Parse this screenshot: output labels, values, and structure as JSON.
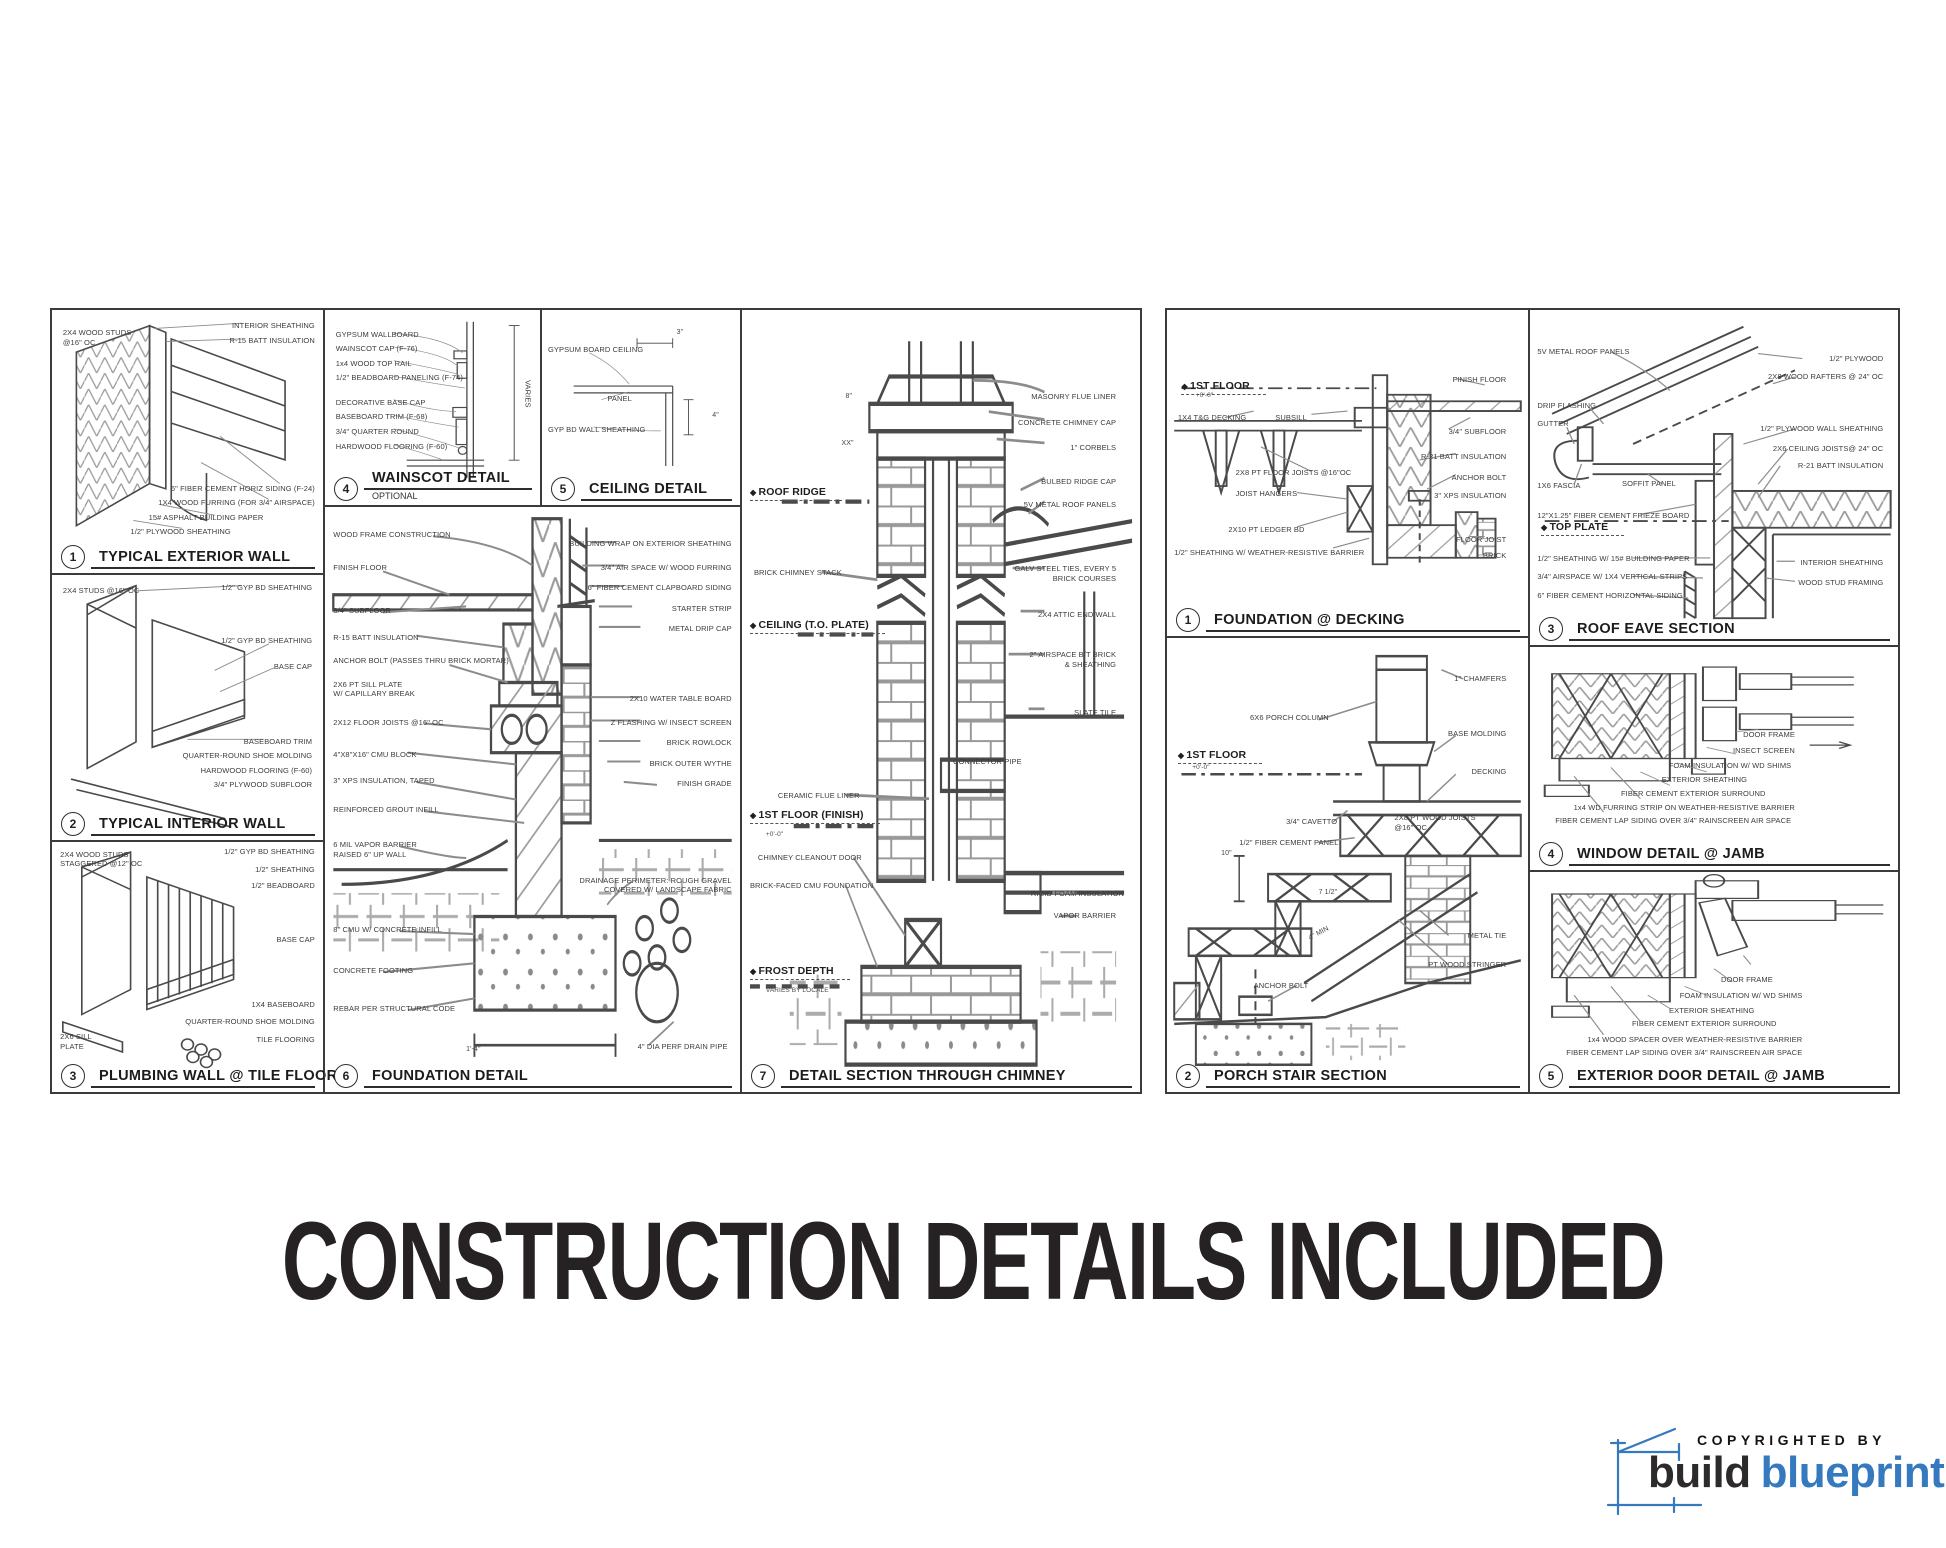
{
  "page": {
    "title": "CONSTRUCTION DETAILS INCLUDED"
  },
  "logo": {
    "copyright": "COPYRIGHTED BY",
    "brand_dark": "build",
    "brand_accent": "blueprint",
    "accent_color": "#3579be",
    "dark_color": "#2d2a2b"
  },
  "left_sheet": {
    "panels": [
      {
        "num": "1",
        "title": "TYPICAL EXTERIOR WALL",
        "labels": [
          {
            "t": "2X4 WOOD STUDS\n@16\" OC",
            "x": 4,
            "y": 7
          },
          {
            "t": "INTERIOR SHEATHING",
            "x": 97,
            "y": 4,
            "a": "r"
          },
          {
            "t": "R-15 BATT INSULATION",
            "x": 97,
            "y": 10,
            "a": "r"
          },
          {
            "t": "6\" FIBER CEMENT HORIZ SIDING (F-24)",
            "x": 97,
            "y": 66,
            "a": "r"
          },
          {
            "t": "1X4 WOOD FURRING (FOR 3/4\" AIRSPACE)",
            "x": 97,
            "y": 71.5,
            "a": "r"
          },
          {
            "t": "15# ASPHALT BUILDING PAPER",
            "x": 78,
            "y": 77,
            "a": "r"
          },
          {
            "t": "1/2\" PLYWOOD SHEATHING",
            "x": 66,
            "y": 82.5,
            "a": "r"
          }
        ]
      },
      {
        "num": "2",
        "title": "TYPICAL INTERIOR WALL",
        "labels": [
          {
            "t": "2X4 STUDS @16\" OC",
            "x": 4,
            "y": 4
          },
          {
            "t": "1/2\" GYP BD SHEATHING",
            "x": 96,
            "y": 3,
            "a": "r"
          },
          {
            "t": "1/2\" GYP BD SHEATHING",
            "x": 96,
            "y": 23,
            "a": "r"
          },
          {
            "t": "BASE CAP",
            "x": 96,
            "y": 33,
            "a": "r"
          },
          {
            "t": "BASEBOARD TRIM",
            "x": 96,
            "y": 61,
            "a": "r"
          },
          {
            "t": "QUARTER-ROUND SHOE MOLDING",
            "x": 96,
            "y": 66.5,
            "a": "r"
          },
          {
            "t": "HARDWOOD FLOORING (F-60)",
            "x": 96,
            "y": 72,
            "a": "r"
          },
          {
            "t": "3/4\" PLYWOOD SUBFLOOR",
            "x": 96,
            "y": 77.5,
            "a": "r"
          }
        ]
      },
      {
        "num": "3",
        "title": "PLUMBING WALL @ TILE FLOOR",
        "labels": [
          {
            "t": "2X4 WOOD STUDS\nSTAGGERED @12\" OC",
            "x": 3,
            "y": 3
          },
          {
            "t": "1/2\" GYP BD SHEATHING",
            "x": 97,
            "y": 2,
            "a": "r"
          },
          {
            "t": "1/2\" SHEATHING",
            "x": 97,
            "y": 9,
            "a": "r"
          },
          {
            "t": "1/2\" BEADBOARD",
            "x": 97,
            "y": 15.5,
            "a": "r"
          },
          {
            "t": "BASE CAP",
            "x": 97,
            "y": 37,
            "a": "r"
          },
          {
            "t": "1X4 BASEBOARD",
            "x": 97,
            "y": 63,
            "a": "r"
          },
          {
            "t": "QUARTER-ROUND SHOE MOLDING",
            "x": 97,
            "y": 70,
            "a": "r"
          },
          {
            "t": "TILE FLOORING",
            "x": 97,
            "y": 77,
            "a": "r"
          },
          {
            "t": "2X6 SILL\nPLATE",
            "x": 3,
            "y": 76
          }
        ]
      },
      {
        "num": "4",
        "title": "WAINSCOT DETAIL",
        "subtitle": "OPTIONAL",
        "labels": [
          {
            "t": "GYPSUM WALLBOARD",
            "x": 5,
            "y": 10
          },
          {
            "t": "WAINSCOT CAP (F-76)",
            "x": 5,
            "y": 17.5
          },
          {
            "t": "1x4 WOOD TOP RAIL",
            "x": 5,
            "y": 25
          },
          {
            "t": "1/2\" BEADBOARD PANELING (F-74)",
            "x": 5,
            "y": 32.5
          },
          {
            "t": "DECORATIVE BASE CAP",
            "x": 5,
            "y": 45
          },
          {
            "t": "BASEBOARD TRIM (F-68)",
            "x": 5,
            "y": 52.5
          },
          {
            "t": "3/4\" QUARTER ROUND",
            "x": 5,
            "y": 60
          },
          {
            "t": "HARDWOOD FLOORING (F-60)",
            "x": 5,
            "y": 67.5
          },
          {
            "t": "VARIES",
            "x": 92,
            "y": 36,
            "cls": "vert"
          }
        ]
      },
      {
        "num": "5",
        "title": "CEILING DETAIL",
        "labels": [
          {
            "t": "GYPSUM BOARD CEILING",
            "x": 3,
            "y": 18
          },
          {
            "t": "PANEL",
            "x": 33,
            "y": 43
          },
          {
            "t": "GYP BD WALL SHEATHING",
            "x": 3,
            "y": 59
          },
          {
            "t": "3\"",
            "x": 68,
            "y": 9,
            "cls": "dim"
          },
          {
            "t": "4\"",
            "x": 86,
            "y": 52,
            "cls": "dim"
          }
        ]
      },
      {
        "num": "6",
        "title": "FOUNDATION DETAIL",
        "labels": [
          {
            "t": "WOOD FRAME CONSTRUCTION",
            "x": 2,
            "y": 4
          },
          {
            "t": "FINISH FLOOR",
            "x": 2,
            "y": 9.5
          },
          {
            "t": "3/4\" SUBFLOOR",
            "x": 2,
            "y": 17
          },
          {
            "t": "R-15 BATT INSULATION",
            "x": 2,
            "y": 21.5
          },
          {
            "t": "ANCHOR BOLT (PASSES THRU BRICK MORTAR)",
            "x": 2,
            "y": 25.5
          },
          {
            "t": "2X6 PT SILL PLATE\nW/ CAPILLARY BREAK",
            "x": 2,
            "y": 29.5
          },
          {
            "t": "2X12 FLOOR JOISTS @16\" OC",
            "x": 2,
            "y": 36
          },
          {
            "t": "4\"X8\"X16\" CMU BLOCK",
            "x": 2,
            "y": 41.5
          },
          {
            "t": "3\" XPS INSULATION, TAPED",
            "x": 2,
            "y": 46
          },
          {
            "t": "REINFORCED GROUT INFILL",
            "x": 2,
            "y": 51
          },
          {
            "t": "6 MIL VAPOR BARRIER\nRAISED 6\" UP WALL",
            "x": 2,
            "y": 57
          },
          {
            "t": "8\" CMU W/ CONCRETE INFILL",
            "x": 2,
            "y": 71.5
          },
          {
            "t": "CONCRETE FOOTING",
            "x": 2,
            "y": 78.5
          },
          {
            "t": "REBAR PER STRUCTURAL CODE",
            "x": 2,
            "y": 85
          },
          {
            "t": "BUILDING WRAP ON EXTERIOR SHEATHING",
            "x": 98,
            "y": 5.5,
            "a": "r"
          },
          {
            "t": "3/4\" AIR SPACE W/ WOOD FURRING",
            "x": 98,
            "y": 9.5,
            "a": "r"
          },
          {
            "t": "6\" FIBER CEMENT CLAPBOARD SIDING",
            "x": 98,
            "y": 13,
            "a": "r"
          },
          {
            "t": "STARTER STRIP",
            "x": 98,
            "y": 16.5,
            "a": "r"
          },
          {
            "t": "METAL DRIP CAP",
            "x": 98,
            "y": 20,
            "a": "r"
          },
          {
            "t": "2X10 WATER TABLE BOARD",
            "x": 98,
            "y": 32,
            "a": "r"
          },
          {
            "t": "Z FLASHING W/ INSECT SCREEN",
            "x": 98,
            "y": 36,
            "a": "r"
          },
          {
            "t": "BRICK ROWLOCK",
            "x": 98,
            "y": 39.5,
            "a": "r"
          },
          {
            "t": "BRICK OUTER WYTHE",
            "x": 98,
            "y": 43,
            "a": "r"
          },
          {
            "t": "FINISH GRADE",
            "x": 98,
            "y": 46.5,
            "a": "r"
          },
          {
            "t": "DRAINAGE PERIMETER: ROUGH GRAVEL\nCOVERED W/ LANDSCAPE FABRIC",
            "x": 98,
            "y": 63,
            "a": "r"
          },
          {
            "t": "4\" DIA PERF DRAIN PIPE",
            "x": 97,
            "y": 91.5,
            "a": "r"
          },
          {
            "t": "1'-4\"",
            "x": 34,
            "y": 92,
            "cls": "dim"
          }
        ]
      },
      {
        "num": "7",
        "title": "DETAIL SECTION THROUGH CHIMNEY",
        "labels": [
          {
            "t": "ROOF RIDGE",
            "x": 2,
            "y": 22.5,
            "cls": "marker"
          },
          {
            "t": "CEILING (T.O. PLATE)",
            "x": 2,
            "y": 39.5,
            "cls": "marker"
          },
          {
            "t": "1ST FLOOR (FINISH)",
            "x": 2,
            "y": 63.8,
            "cls": "marker"
          },
          {
            "t": "+0'-0\"",
            "x": 6,
            "y": 66.6,
            "cls": "sub"
          },
          {
            "t": "FROST DEPTH",
            "x": 2,
            "y": 83.8,
            "cls": "marker"
          },
          {
            "t": "VARIES BY LOCALE",
            "x": 6,
            "y": 86.6,
            "cls": "sub"
          },
          {
            "t": "BRICK CHIMNEY STACK",
            "x": 3,
            "y": 33
          },
          {
            "t": "CERAMIC FLUE LINER",
            "x": 9,
            "y": 61.5
          },
          {
            "t": "CHIMNEY CLEANOUT DOOR",
            "x": 4,
            "y": 69.5
          },
          {
            "t": "BRICK-FACED CMU FOUNDATION",
            "x": 2,
            "y": 73
          },
          {
            "t": "MASONRY FLUE LINER",
            "x": 94,
            "y": 10.5,
            "a": "r"
          },
          {
            "t": "CONCRETE CHIMNEY CAP",
            "x": 94,
            "y": 13.8,
            "a": "r"
          },
          {
            "t": "1\" CORBELS",
            "x": 94,
            "y": 17,
            "a": "r"
          },
          {
            "t": "BULBED RIDGE CAP",
            "x": 94,
            "y": 21.3,
            "a": "r"
          },
          {
            "t": "5V METAL ROOF PANELS",
            "x": 94,
            "y": 24.3,
            "a": "r"
          },
          {
            "t": "GALV STEEL TIES, EVERY 5\nBRICK COURSES",
            "x": 94,
            "y": 32.5,
            "a": "r"
          },
          {
            "t": "2X4 ATTIC END WALL",
            "x": 94,
            "y": 38.3,
            "a": "r"
          },
          {
            "t": "2\" AIRSPACE B/T BRICK\n& SHEATHING",
            "x": 94,
            "y": 43.5,
            "a": "r"
          },
          {
            "t": "SLATE TILE",
            "x": 94,
            "y": 50.9,
            "a": "r"
          },
          {
            "t": "CONNECTOR PIPE",
            "x": 53,
            "y": 57.2
          },
          {
            "t": "RIGID FOAM INSULATION",
            "x": 96,
            "y": 74,
            "a": "r"
          },
          {
            "t": "VAPOR BARRIER",
            "x": 94,
            "y": 76.8,
            "a": "r"
          },
          {
            "t": "8\"",
            "x": 26,
            "y": 10.5,
            "cls": "dim"
          },
          {
            "t": "XX\"",
            "x": 25,
            "y": 16.5,
            "cls": "dim"
          }
        ]
      }
    ]
  },
  "right_sheet": {
    "panels": [
      {
        "num": "1",
        "title": "FOUNDATION @ DECKING",
        "labels": [
          {
            "t": "1ST FLOOR",
            "x": 4,
            "y": 21.5,
            "cls": "marker"
          },
          {
            "t": "+0'-0\"",
            "x": 8,
            "y": 25,
            "cls": "sub"
          },
          {
            "t": "1X4 T&G DECKING",
            "x": 3,
            "y": 31.5
          },
          {
            "t": "SUBSILL",
            "x": 30,
            "y": 31.5
          },
          {
            "t": "FINISH FLOOR",
            "x": 94,
            "y": 20,
            "a": "r"
          },
          {
            "t": "3/4\" SUBFLOOR",
            "x": 94,
            "y": 36,
            "a": "r"
          },
          {
            "t": "R-21 BATT INSULATION",
            "x": 94,
            "y": 43.5,
            "a": "r"
          },
          {
            "t": "ANCHOR BOLT",
            "x": 94,
            "y": 50,
            "a": "r"
          },
          {
            "t": "3\" XPS INSULATION",
            "x": 94,
            "y": 55.5,
            "a": "r"
          },
          {
            "t": "2X8 PT FLOOR JOISTS @16\"OC",
            "x": 19,
            "y": 48.5
          },
          {
            "t": "JOIST HANGERS",
            "x": 19,
            "y": 55
          },
          {
            "t": "2X10 PT LEDGER BD",
            "x": 17,
            "y": 66
          },
          {
            "t": "1/2\" SHEATHING W/ WEATHER-RESISTIVE BARRIER",
            "x": 2,
            "y": 72.9
          },
          {
            "t": "FLOOR JOIST",
            "x": 94,
            "y": 69,
            "a": "r"
          },
          {
            "t": "BRICK",
            "x": 94,
            "y": 74,
            "a": "r"
          }
        ]
      },
      {
        "num": "2",
        "title": "PORCH STAIR SECTION",
        "labels": [
          {
            "t": "1\" CHAMFERS",
            "x": 94,
            "y": 8,
            "a": "r"
          },
          {
            "t": "6X6 PORCH COLUMN",
            "x": 23,
            "y": 16.5
          },
          {
            "t": "BASE MOLDING",
            "x": 94,
            "y": 20,
            "a": "r"
          },
          {
            "t": "1ST FLOOR",
            "x": 3,
            "y": 24.5,
            "cls": "marker"
          },
          {
            "t": "+0'-0\"",
            "x": 7,
            "y": 27.8,
            "cls": "sub"
          },
          {
            "t": "DECKING",
            "x": 94,
            "y": 28.5,
            "a": "r"
          },
          {
            "t": "3/4\" CAVETTO",
            "x": 33,
            "y": 39.5
          },
          {
            "t": "1/2\" FIBER CEMENT PANEL",
            "x": 20,
            "y": 44
          },
          {
            "t": "2X8 PT WOOD JOISTS\n@16\" OC",
            "x": 63,
            "y": 38.5
          },
          {
            "t": "METAL TIE",
            "x": 94,
            "y": 64.5,
            "a": "r"
          },
          {
            "t": "PT WOOD STRINGER",
            "x": 94,
            "y": 71,
            "a": "r"
          },
          {
            "t": "ANCHOR BOLT",
            "x": 24,
            "y": 75.5
          },
          {
            "t": "10\"",
            "x": 15,
            "y": 46.5,
            "cls": "dim"
          },
          {
            "t": "7 1/2\"",
            "x": 42,
            "y": 55,
            "cls": "dim"
          },
          {
            "t": "4\" MIN",
            "x": 39,
            "y": 64,
            "cls": "dim rot"
          }
        ]
      },
      {
        "num": "3",
        "title": "ROOF EAVE SECTION",
        "labels": [
          {
            "t": "5V METAL ROOF PANELS",
            "x": 2,
            "y": 11
          },
          {
            "t": "1/2\" PLYWOOD",
            "x": 96,
            "y": 13,
            "a": "r"
          },
          {
            "t": "2X8 WOOD RAFTERS @ 24\" OC",
            "x": 96,
            "y": 18.4,
            "a": "r"
          },
          {
            "t": "DRIP FLASHING",
            "x": 2,
            "y": 27.3
          },
          {
            "t": "GUTTER",
            "x": 2,
            "y": 32.6
          },
          {
            "t": "1/2\" PLYWOOD WALL SHEATHING",
            "x": 96,
            "y": 34.1,
            "a": "r"
          },
          {
            "t": "2X6 CEILING JOISTS@ 24\" OC",
            "x": 96,
            "y": 40.1,
            "a": "r"
          },
          {
            "t": "R-21 BATT INSULATION",
            "x": 96,
            "y": 45.1,
            "a": "r"
          },
          {
            "t": "1X6 FASCIA",
            "x": 2,
            "y": 51
          },
          {
            "t": "SOFFIT PANEL",
            "x": 25,
            "y": 50.4
          },
          {
            "t": "12\"X1.25\" FIBER CEMENT FRIEZE BOARD",
            "x": 2,
            "y": 59.9
          },
          {
            "t": "TOP PLATE",
            "x": 3,
            "y": 63,
            "cls": "marker"
          },
          {
            "t": "1/2\" SHEATHING W/ 15# BUILDING PAPER",
            "x": 2,
            "y": 72.7
          },
          {
            "t": "3/4\" AIRSPACE W/ 1X4 VERTICAL STRIPS",
            "x": 2,
            "y": 78.3
          },
          {
            "t": "6\" FIBER CEMENT HORIZONTAL SIDING",
            "x": 2,
            "y": 83.8
          },
          {
            "t": "INTERIOR SHEATHING",
            "x": 96,
            "y": 73.9,
            "a": "r"
          },
          {
            "t": "WOOD STUD FRAMING",
            "x": 96,
            "y": 80,
            "a": "r"
          }
        ]
      },
      {
        "num": "4",
        "title": "WINDOW DETAIL @ JAMB",
        "labels": [
          {
            "t": "DOOR FRAME",
            "x": 72,
            "y": 37,
            "a": "r"
          },
          {
            "t": "INSECT SCREEN",
            "x": 72,
            "y": 44.5,
            "a": "r"
          },
          {
            "t": "FOAM INSULATION W/ WD SHIMS",
            "x": 71,
            "y": 51,
            "a": "r"
          },
          {
            "t": "EXTERIOR SHEATHING",
            "x": 59,
            "y": 57.5,
            "a": "r"
          },
          {
            "t": "FIBER CEMENT EXTERIOR SURROUND",
            "x": 64,
            "y": 63.8,
            "a": "r"
          },
          {
            "t": "1x4 WD FURRING STRIP ON WEATHER-RESISTIVE BARRIER",
            "x": 72,
            "y": 70,
            "a": "r"
          },
          {
            "t": "FIBER CEMENT LAP SIDING OVER 3/4\" RAINSCREEN AIR SPACE",
            "x": 71,
            "y": 76,
            "a": "r"
          }
        ]
      },
      {
        "num": "5",
        "title": "EXTERIOR DOOR DETAIL @ JAMB",
        "labels": [
          {
            "t": "DOOR FRAME",
            "x": 66,
            "y": 47,
            "a": "r"
          },
          {
            "t": "FOAM INSULATION W/ WD SHIMS",
            "x": 74,
            "y": 54,
            "a": "r"
          },
          {
            "t": "EXTERIOR SHEATHING",
            "x": 61,
            "y": 60.8,
            "a": "r"
          },
          {
            "t": "FIBER CEMENT EXTERIOR SURROUND",
            "x": 67,
            "y": 67,
            "a": "r"
          },
          {
            "t": "1x4 WOOD SPACER OVER WEATHER-RESISTIVE BARRIER",
            "x": 74,
            "y": 73.9,
            "a": "r"
          },
          {
            "t": "FIBER CEMENT LAP SIDING OVER 3/4\" RAINSCREEN AIR SPACE",
            "x": 74,
            "y": 80,
            "a": "r"
          }
        ]
      }
    ]
  }
}
